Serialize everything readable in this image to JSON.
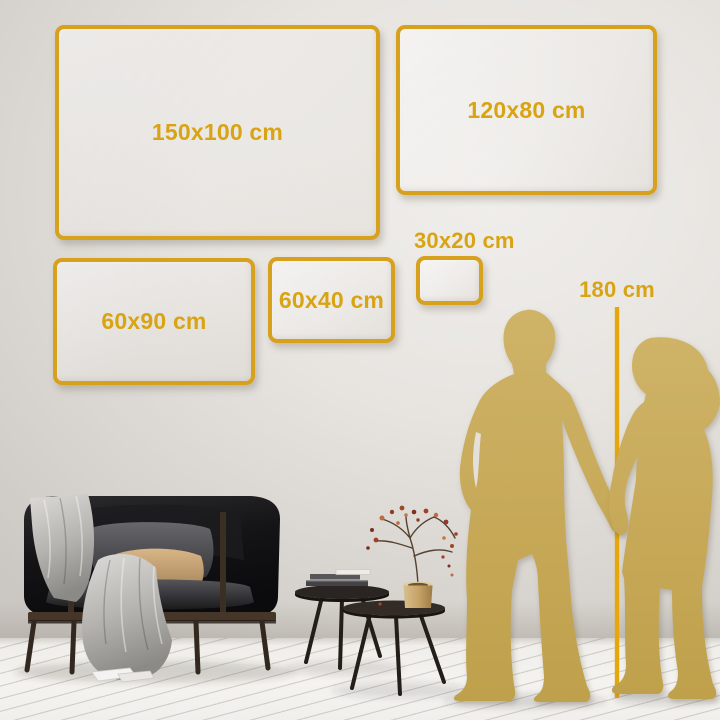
{
  "palette": {
    "frame_gold": "#D7A11E",
    "label_gold": "#D9A413",
    "ruler_gold": "#E6A70D",
    "silhouette_gold": "#C7A958",
    "wall_light": "#EDEBE8",
    "wall_dark": "#CFCBC6",
    "floor": "#F2F0ED"
  },
  "size_guide": {
    "frames": [
      {
        "size": "150x100",
        "label": "150x100 cm"
      },
      {
        "size": "120x80",
        "label": "120x80 cm"
      },
      {
        "size": "60x90",
        "label": "60x90 cm"
      },
      {
        "size": "60x40",
        "label": "60x40 cm"
      },
      {
        "size": "30x20",
        "label": "30x20 cm"
      }
    ],
    "ruler": {
      "label": "180 cm"
    }
  },
  "decor": {
    "items": [
      "dark-sofa",
      "throw-blanket",
      "pillows",
      "nesting-coffee-tables",
      "books",
      "brass-vase-dried-flowers",
      "man-silhouette",
      "woman-silhouette"
    ]
  }
}
